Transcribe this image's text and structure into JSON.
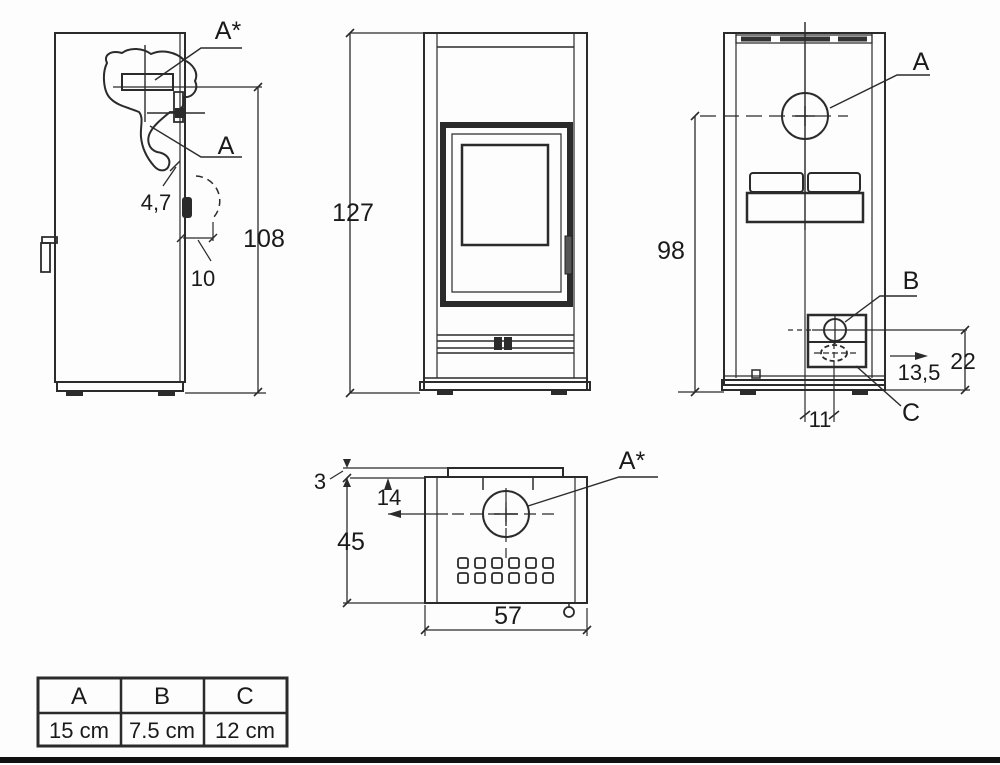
{
  "views": {
    "side": {
      "label_a_star": "A*",
      "label_a": "A",
      "dim_4_7": "4,7",
      "dim_10": "10",
      "dim_108": "108"
    },
    "front": {
      "dim_127": "127"
    },
    "back": {
      "label_a": "A",
      "label_b": "B",
      "label_c": "C",
      "dim_98": "98",
      "dim_22": "22",
      "dim_13_5": "13,5",
      "dim_11": "11"
    },
    "top": {
      "label_a_star": "A*",
      "dim_3": "3",
      "dim_14": "14",
      "dim_45": "45",
      "dim_57": "57"
    }
  },
  "table": {
    "headers": [
      "A",
      "B",
      "C"
    ],
    "values": [
      "15 cm",
      "7.5 cm",
      "12 cm"
    ]
  },
  "colors": {
    "line": "#2b2b2b",
    "text": "#1a1a1a",
    "background": "#fdfdfd",
    "bottom_bar": "#111111"
  }
}
